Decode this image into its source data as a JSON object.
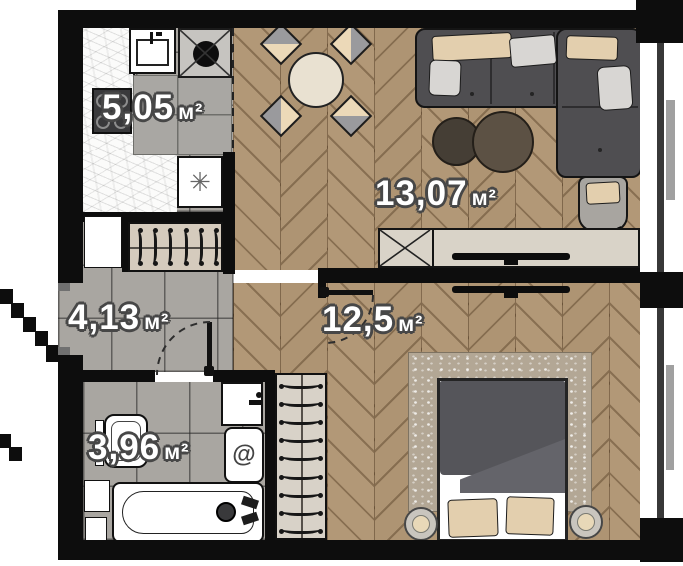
{
  "rooms": {
    "kitchen": {
      "area": "5,05",
      "unit": "м²"
    },
    "living_room": {
      "area": "13,07",
      "unit": "м²"
    },
    "bedroom": {
      "area": "12,5",
      "unit": "м²"
    },
    "hallway": {
      "area": "4,13",
      "unit": "м²"
    },
    "bathroom": {
      "area": "3,96",
      "unit": "м²"
    }
  },
  "icons": {
    "fridge_glyph": "✳",
    "washing_machine_glyph": "@"
  },
  "colors": {
    "wall": "#0d0d0d",
    "wood_floor": "#b29877",
    "tile_floor": "#a9a6a1",
    "countertop": "#fbfbfa",
    "sofa": "#4f4e51",
    "pillow_beige": "#e3cfae",
    "duvet": "#55555a",
    "label_text": "#ffffff",
    "label_outline": "#474747"
  }
}
